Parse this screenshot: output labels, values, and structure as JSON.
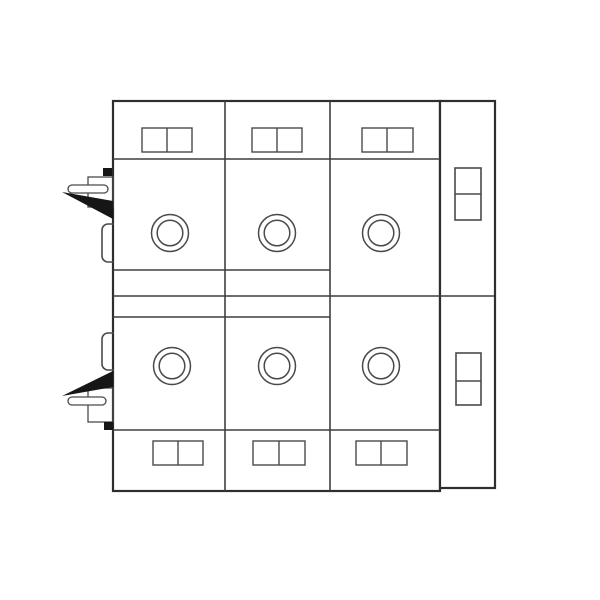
{
  "page": {
    "background": "#ffffff"
  },
  "drawing": {
    "canvas": {
      "width": 600,
      "height": 600
    },
    "colors": {
      "outline": "#2e2e2e",
      "grid_line": "#3f3f3f",
      "thin_line": "#4a4a4a",
      "solid_black": "#161616",
      "fill": "#ffffff"
    },
    "shapes": [
      {
        "name": "device-body-outline",
        "type": "rect",
        "x": 113,
        "y": 101,
        "w": 327,
        "h": 390,
        "stroke": "#2e2e2e",
        "sw": 2.2,
        "fill": "#ffffff"
      },
      {
        "name": "side-channel-outline",
        "type": "rect",
        "x": 440,
        "y": 101,
        "w": 55,
        "h": 387,
        "stroke": "#2e2e2e",
        "sw": 2.2,
        "fill": "#ffffff"
      },
      {
        "name": "module-divider-left",
        "type": "line",
        "x1": 225,
        "y1": 101,
        "x2": 225,
        "y2": 491,
        "stroke": "#3f3f3f",
        "sw": 1.6
      },
      {
        "name": "module-divider-right",
        "type": "line",
        "x1": 330,
        "y1": 101,
        "x2": 330,
        "y2": 491,
        "stroke": "#3f3f3f",
        "sw": 1.6
      },
      {
        "name": "top-band-line",
        "type": "line",
        "x1": 113,
        "y1": 159,
        "x2": 440,
        "y2": 159,
        "stroke": "#3f3f3f",
        "sw": 1.4
      },
      {
        "name": "bottom-band-line",
        "type": "line",
        "x1": 113,
        "y1": 430,
        "x2": 440,
        "y2": 430,
        "stroke": "#3f3f3f",
        "sw": 1.4
      },
      {
        "name": "mid-band-upper-line",
        "type": "line",
        "x1": 113,
        "y1": 270,
        "x2": 330,
        "y2": 270,
        "stroke": "#3f3f3f",
        "sw": 1.4
      },
      {
        "name": "mid-band-center-line",
        "type": "line",
        "x1": 113,
        "y1": 296,
        "x2": 494,
        "y2": 296,
        "stroke": "#3f3f3f",
        "sw": 1.6
      },
      {
        "name": "mid-band-lower-line",
        "type": "line",
        "x1": 113,
        "y1": 317,
        "x2": 330,
        "y2": 317,
        "stroke": "#3f3f3f",
        "sw": 1.4
      },
      {
        "name": "terminal-window-top-1",
        "type": "rect",
        "x": 142,
        "y": 128,
        "w": 50,
        "h": 24,
        "stroke": "#4a4a4a",
        "sw": 1.4,
        "fill": "none"
      },
      {
        "name": "terminal-window-top-1-divider",
        "type": "line",
        "x1": 167,
        "y1": 128,
        "x2": 167,
        "y2": 152,
        "stroke": "#4a4a4a",
        "sw": 1.4
      },
      {
        "name": "terminal-window-top-2",
        "type": "rect",
        "x": 252,
        "y": 128,
        "w": 50,
        "h": 24,
        "stroke": "#4a4a4a",
        "sw": 1.4,
        "fill": "none"
      },
      {
        "name": "terminal-window-top-2-divider",
        "type": "line",
        "x1": 277,
        "y1": 128,
        "x2": 277,
        "y2": 152,
        "stroke": "#4a4a4a",
        "sw": 1.4
      },
      {
        "name": "terminal-window-top-3",
        "type": "rect",
        "x": 362,
        "y": 128,
        "w": 51,
        "h": 24,
        "stroke": "#4a4a4a",
        "sw": 1.4,
        "fill": "none"
      },
      {
        "name": "terminal-window-top-3-divider",
        "type": "line",
        "x1": 387,
        "y1": 128,
        "x2": 387,
        "y2": 152,
        "stroke": "#4a4a4a",
        "sw": 1.4
      },
      {
        "name": "terminal-window-bottom-1",
        "type": "line-group-rect",
        "x": 153,
        "y": 441,
        "w": 50,
        "h": 24,
        "stroke": "#4a4a4a",
        "sw": 1.4,
        "fill": "none",
        "type_real": "rect",
        "type2": "rect",
        "typefix": "rect",
        "type_final": "rect",
        "typeoverride": "rect",
        "type_": "rect",
        "typecorrect": "rect",
        "typeuse": "rect",
        "use": "rect",
        "render": "rect"
      },
      {
        "name": "terminal-window-bottom-1-divider",
        "type": "line",
        "x1": 178,
        "y1": 441,
        "x2": 178,
        "y2": 465,
        "stroke": "#4a4a4a",
        "sw": 1.4
      },
      {
        "name": "terminal-window-bottom-2",
        "type": "rect",
        "x": 253,
        "y": 441,
        "w": 52,
        "h": 24,
        "stroke": "#4a4a4a",
        "sw": 1.4,
        "fill": "none"
      },
      {
        "name": "terminal-window-bottom-2-divider",
        "type": "line",
        "x1": 279,
        "y1": 441,
        "x2": 279,
        "y2": 465,
        "stroke": "#4a4a4a",
        "sw": 1.4
      },
      {
        "name": "terminal-window-bottom-3",
        "type": "rect",
        "x": 356,
        "y": 441,
        "w": 51,
        "h": 24,
        "stroke": "#4a4a4a",
        "sw": 1.4,
        "fill": "none"
      },
      {
        "name": "terminal-window-bottom-3-divider",
        "type": "line",
        "x1": 381,
        "y1": 441,
        "x2": 381,
        "y2": 465,
        "stroke": "#4a4a4a",
        "sw": 1.4
      },
      {
        "name": "knob-top-1-outer",
        "type": "circle",
        "cx": 170,
        "cy": 233,
        "r": 18.5,
        "stroke": "#4a4a4a",
        "sw": 1.5,
        "fill": "none"
      },
      {
        "name": "knob-top-1-inner",
        "type": "circle",
        "cx": 170,
        "cy": 233,
        "r": 12.8,
        "stroke": "#4a4a4a",
        "sw": 1.5,
        "fill": "none"
      },
      {
        "name": "knob-top-2-outer",
        "type": "circle",
        "cx": 277,
        "cy": 233,
        "r": 18.5,
        "stroke": "#4a4a4a",
        "sw": 1.5,
        "fill": "none"
      },
      {
        "name": "knob-top-2-inner",
        "type": "circle",
        "cx": 277,
        "cy": 233,
        "r": 12.8,
        "stroke": "#4a4a4a",
        "sw": 1.5,
        "fill": "none"
      },
      {
        "name": "knob-top-3-outer",
        "type": "circle",
        "cx": 381,
        "cy": 233,
        "r": 18.5,
        "stroke": "#4a4a4a",
        "sw": 1.5,
        "fill": "none"
      },
      {
        "name": "knob-top-3-inner",
        "type": "circle",
        "cx": 381,
        "cy": 233,
        "r": 12.8,
        "stroke": "#4a4a4a",
        "sw": 1.5,
        "fill": "none"
      },
      {
        "name": "knob-bottom-1-outer",
        "type": "circle",
        "cx": 172,
        "cy": 366,
        "r": 18.5,
        "stroke": "#4a4a4a",
        "sw": 1.5,
        "fill": "none"
      },
      {
        "name": "knob-bottom-1-inner",
        "type": "circle",
        "cx": 172,
        "cy": 366,
        "r": 12.8,
        "stroke": "#4a4a4a",
        "sw": 1.5,
        "fill": "none"
      },
      {
        "name": "knob-bottom-2-outer",
        "type": "circle",
        "cx": 277,
        "cy": 366,
        "r": 18.5,
        "stroke": "#4a4a4a",
        "sw": 1.5,
        "fill": "none"
      },
      {
        "name": "knob-bottom-2-inner",
        "type": "circle",
        "cx": 277,
        "cy": 366,
        "r": 12.8,
        "stroke": "#4a4a4a",
        "sw": 1.5,
        "fill": "none"
      },
      {
        "name": "knob-bottom-3-outer",
        "type": "circle",
        "cx": 381,
        "cy": 366,
        "r": 18.5,
        "stroke": "#4a4a4a",
        "sw": 1.5,
        "fill": "none"
      },
      {
        "name": "knob-bottom-3-inner",
        "type": "circle",
        "cx": 381,
        "cy": 366,
        "r": 12.8,
        "stroke": "#4a4a4a",
        "sw": 1.5,
        "fill": "none"
      },
      {
        "name": "side-window-top",
        "type": "rect",
        "x": 455,
        "y": 168,
        "w": 26,
        "h": 52,
        "stroke": "#4a4a4a",
        "sw": 1.6,
        "fill": "none"
      },
      {
        "name": "side-window-top-divider",
        "type": "line",
        "x1": 455,
        "y1": 194,
        "x2": 481,
        "y2": 194,
        "stroke": "#4a4a4a",
        "sw": 1.6
      },
      {
        "name": "side-window-bottom",
        "type": "rect",
        "x": 456,
        "y": 353,
        "w": 25,
        "h": 52,
        "stroke": "#4a4a4a",
        "sw": 1.6,
        "fill": "none"
      },
      {
        "name": "side-window-bottom-divider",
        "type": "line",
        "x1": 456,
        "y1": 381,
        "x2": 481,
        "y2": 381,
        "stroke": "#4a4a4a",
        "sw": 1.6
      },
      {
        "name": "top-clip-bracket",
        "type": "rect",
        "x": 88,
        "y": 177,
        "w": 25,
        "h": 30,
        "stroke": "#4a4a4a",
        "sw": 1.3,
        "fill": "none"
      },
      {
        "name": "top-clip-lever",
        "type": "rect",
        "x": 68,
        "y": 185,
        "w": 40,
        "h": 8,
        "rx": 4,
        "stroke": "#4a4a4a",
        "sw": 1.3,
        "fill": "#ffffff"
      },
      {
        "name": "top-clip-stop-block",
        "type": "rect",
        "x": 103,
        "y": 168,
        "w": 9,
        "h": 8,
        "stroke": "none",
        "sw": 0,
        "fill": "#161616"
      },
      {
        "name": "top-clip-arrow",
        "type": "polygon",
        "points": "62,192 113,201 113,219",
        "stroke": "none",
        "sw": 0,
        "fill": "#161616"
      },
      {
        "name": "top-clip-latch",
        "type": "path",
        "d": "M114,224 L108,224 A6,6 0 0 0 102,230 L102,256 A6,6 0 0 0 108,262 L114,262",
        "stroke": "#4a4a4a",
        "sw": 1.6,
        "fill": "none"
      },
      {
        "name": "bottom-clip-latch",
        "type": "path",
        "d": "M114,333 L108,333 A6,6 0 0 0 102,339 L102,364 A6,6 0 0 0 108,370 L114,370",
        "stroke": "#4a4a4a",
        "sw": 1.6,
        "fill": "none"
      },
      {
        "name": "bottom-clip-bracket",
        "type": "rect",
        "x": 88,
        "y": 388,
        "w": 25,
        "h": 34,
        "stroke": "#4a4a4a",
        "sw": 1.3,
        "fill": "none"
      },
      {
        "name": "bottom-clip-lever",
        "type": "rect",
        "x": 68,
        "y": 397,
        "w": 38,
        "h": 8,
        "rx": 4,
        "stroke": "#4a4a4a",
        "sw": 1.3,
        "fill": "#ffffff"
      },
      {
        "name": "bottom-clip-arrow",
        "type": "polygon",
        "points": "62,396 113,371 113,387",
        "stroke": "none",
        "sw": 0,
        "fill": "#161616"
      },
      {
        "name": "bottom-clip-stop-block",
        "type": "rect",
        "x": 104,
        "y": 422,
        "w": 9,
        "h": 8,
        "stroke": "none",
        "sw": 0,
        "fill": "#161616"
      }
    ]
  }
}
